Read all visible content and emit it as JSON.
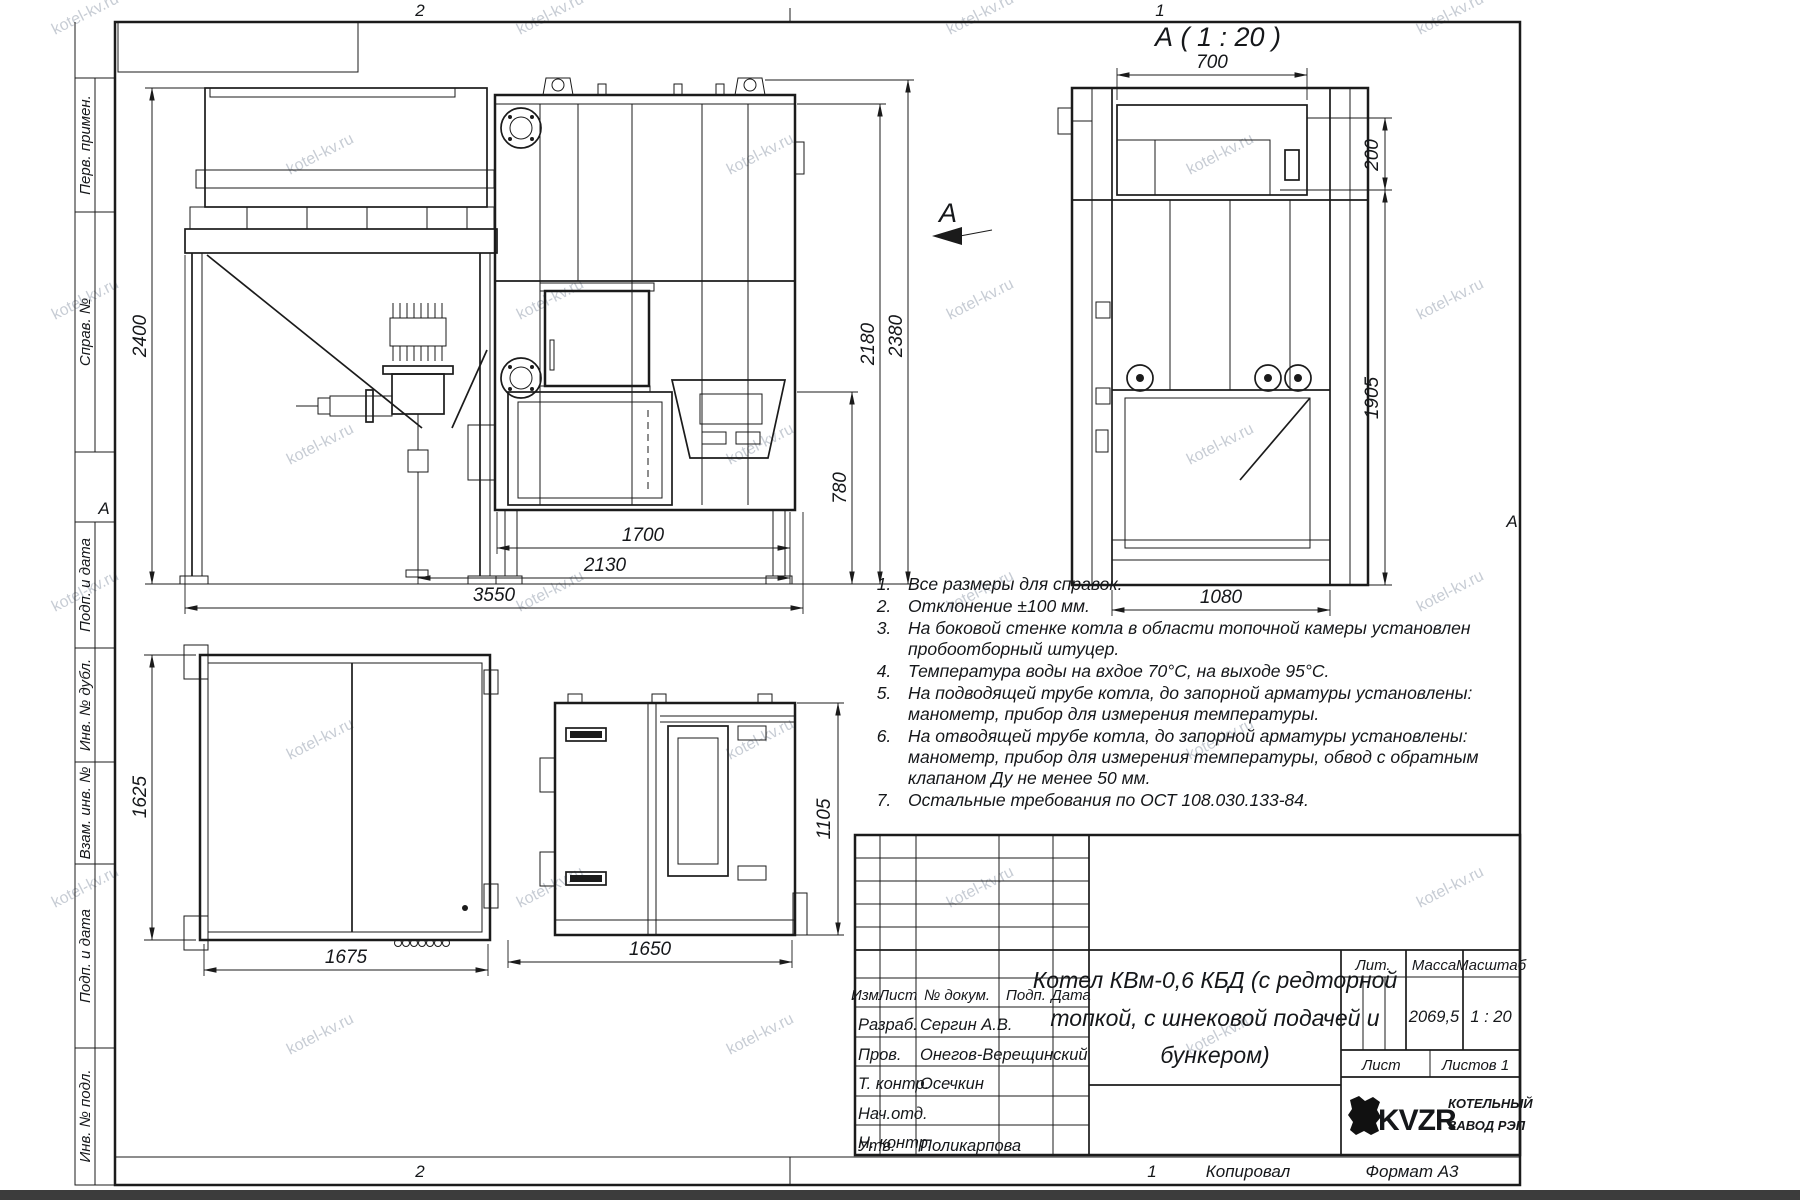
{
  "watermark": "kotel-kv.ru",
  "frame": {
    "zone_top_left": "2",
    "zone_top_right": "1",
    "zone_bottom_left": "2",
    "zone_bottom_right": "1",
    "copied_label": "Копировал",
    "format_label": "Формат А3",
    "fold_mark_left": "А",
    "fold_mark_right": "А"
  },
  "sidebar": {
    "items": [
      {
        "label": "Перв. примен."
      },
      {
        "label": "Справ. №"
      },
      {
        "label": "Подп. и дата"
      },
      {
        "label": "Инв. № дубл."
      },
      {
        "label": "Взам. инв. №"
      },
      {
        "label": "Подп. и дата"
      },
      {
        "label": "Инв. № подл."
      }
    ]
  },
  "views": {
    "section_title": "А ( 1 : 20 )",
    "view_arrow_label": "А"
  },
  "dimensions": {
    "front": {
      "height_total": "2400",
      "w1700": "1700",
      "w2130": "2130",
      "w3550": "3550",
      "h780": "780",
      "h2180": "2180",
      "h2380": "2380"
    },
    "section": {
      "w700": "700",
      "h200": "200",
      "h1905": "1905",
      "w1080": "1080"
    },
    "plan": {
      "h1625": "1625",
      "w1675": "1675"
    },
    "side": {
      "h1105": "1105",
      "w1650": "1650"
    }
  },
  "notes": {
    "items": [
      {
        "num": "1.",
        "lines": [
          "Все размеры для справок."
        ]
      },
      {
        "num": "2.",
        "lines": [
          "Отклонение ±100 мм."
        ]
      },
      {
        "num": "3.",
        "lines": [
          "На боковой стенке котла в области топочной камеры установлен",
          "пробоотборный штуцер."
        ]
      },
      {
        "num": "4.",
        "lines": [
          "Температура воды на вхдое 70°С, на выходе 95°С."
        ]
      },
      {
        "num": "5.",
        "lines": [
          "На подводящей трубе котла, до запорной арматуры установлены:",
          "манометр, прибор для измерения температуры."
        ]
      },
      {
        "num": "6.",
        "lines": [
          "На отводящей трубе котла, до запорной арматуры установлены:",
          "манометр, прибор для измерения температуры, обвод с обратным",
          "клапаном Ду не менее 50 мм."
        ]
      },
      {
        "num": "7.",
        "lines": [
          "Остальные требования по ОСТ 108.030.133-84."
        ]
      }
    ]
  },
  "title_block": {
    "header": {
      "izm": "Изм.",
      "list": "Лист",
      "doc": "№ докум.",
      "podp": "Подп.",
      "data": "Дата"
    },
    "rows": [
      {
        "role": "Разраб.",
        "name": "Сергин А.В."
      },
      {
        "role": "Пров.",
        "name": "Онегов-Верещинский"
      },
      {
        "role": "Т. контр.",
        "name": "Осечкин"
      },
      {
        "role": "Нач.отд.",
        "name": ""
      },
      {
        "role": "Н. контр.",
        "name": ""
      },
      {
        "role": "Утв.",
        "name": "Поликарпова"
      }
    ],
    "title_lines": [
      "Котел КВм-0,6 КБД (с редторной",
      "топкой, с шнековой подачей и",
      "бункером)"
    ],
    "title": "Котел КВм-0,6 КБД (с редторной топкой, с шнековой подачей и бункером)",
    "lit_label": "Лит.",
    "mass_label": "Масса",
    "scale_label": "Масштаб",
    "mass_value": "2069,5",
    "scale_value": "1 : 20",
    "sheet_label": "Лист",
    "sheets_label": "Листов",
    "sheets_value": "1",
    "logo_text": "KVZR",
    "company_lines": [
      "КОТЕЛЬНЫЙ",
      "ЗАВОД РЭП"
    ]
  }
}
